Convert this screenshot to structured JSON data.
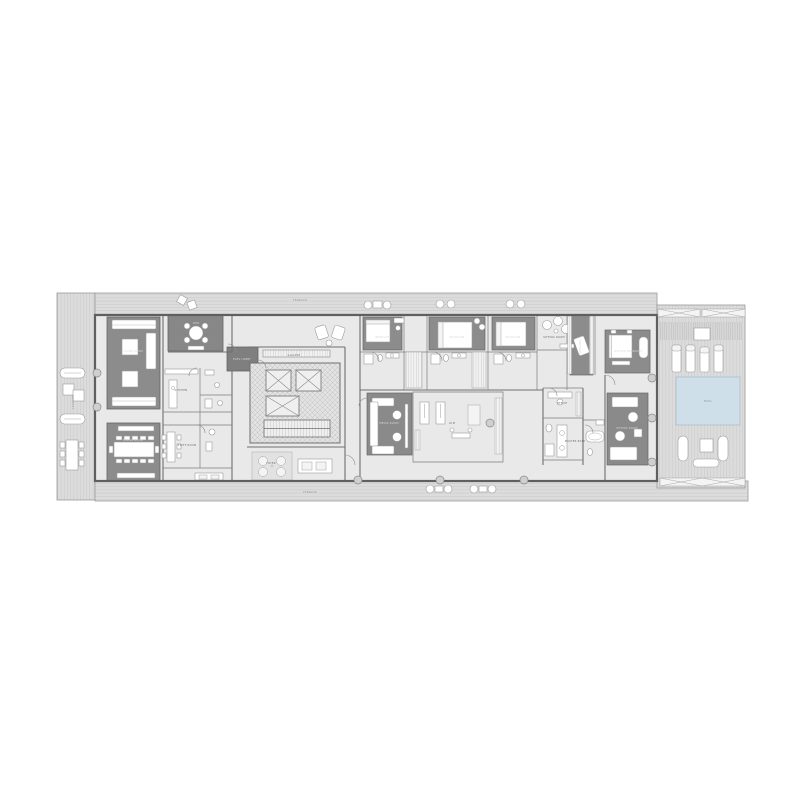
{
  "meta": {
    "type": "architectural-floor-plan",
    "view": "single floor plan drawing on white background"
  },
  "palette": {
    "background": "#ffffff",
    "deck": "#dcdcdc",
    "deck_line": "#c2c2c2",
    "floor": "#e9e9e9",
    "wall": "#5f5f5f",
    "dark_room_floor": "#8c8c8c",
    "furniture": "#ffffff",
    "pool_water": "#cfdfe9",
    "core_hatch": "#bdbdbd"
  },
  "labels": {
    "terrace": "TERRACE",
    "living_room": "LIVING ROOM",
    "dining_room": "DINING ROOM",
    "den": "DEN",
    "kitchen": "KITCHEN",
    "staff_room": "STAFF ROOM",
    "gallery": "GALLERY",
    "foyer": "FOYER",
    "elevator_lobby": "ELEV LOBBY",
    "media_room": "MEDIA ROOM",
    "gym": "GYM",
    "bedroom": "BEDROOM",
    "sitting_room": "SITTING ROOM",
    "dressing": "DRESSING",
    "office": "OFFICE",
    "master_bath": "MASTER BATH",
    "master_bedroom": "MASTER BEDROOM",
    "pool": "POOL"
  }
}
